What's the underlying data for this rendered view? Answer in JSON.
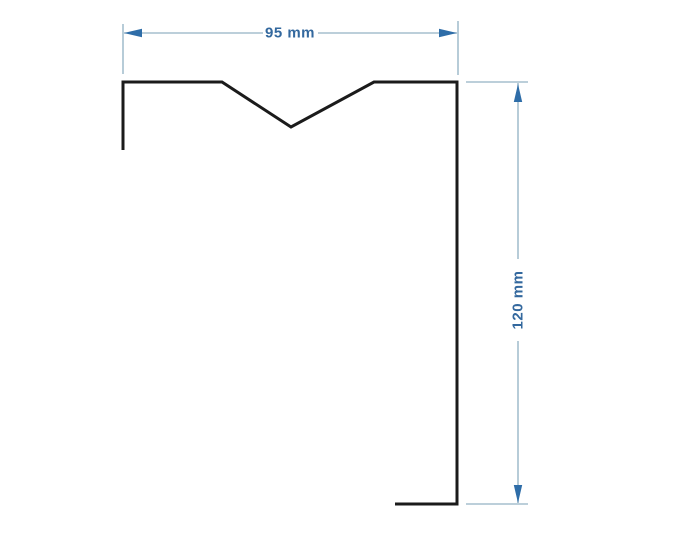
{
  "drawing": {
    "kind": "technical-profile-drawing",
    "background": "#ffffff",
    "colors": {
      "profile_line": "#1b1b1b",
      "dimension_line": "#a5bfce",
      "arrow": "#2e6da8",
      "label_text": "#33689e"
    },
    "dimensions": {
      "width": {
        "label": "95 mm",
        "value": 95,
        "unit": "mm",
        "orientation": "horizontal"
      },
      "height": {
        "label": "120 mm",
        "value": 120,
        "unit": "mm",
        "orientation": "vertical"
      }
    }
  }
}
